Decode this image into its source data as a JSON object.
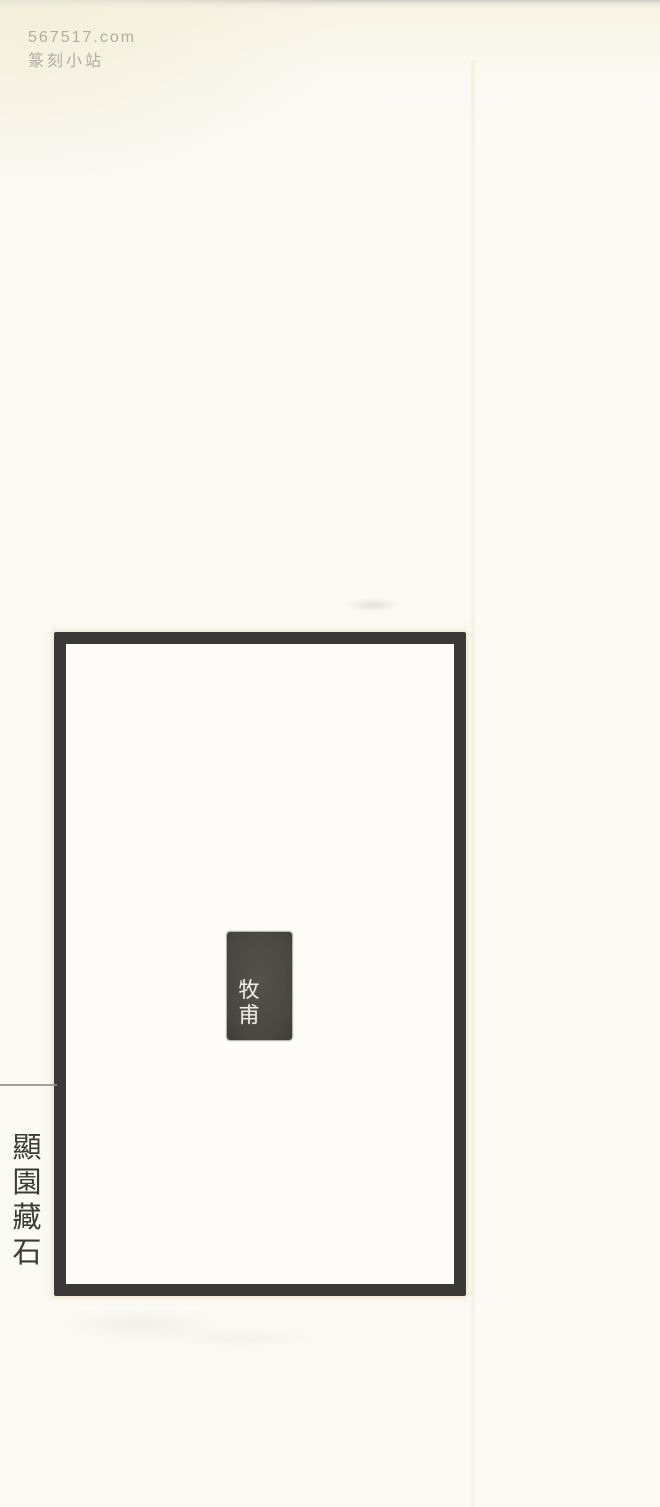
{
  "watermark": {
    "site": "567517.com",
    "name": "篆刻小站",
    "color": "#b0aca4"
  },
  "plate": {
    "border_color": "#3a3935",
    "paper_color": "#fdfcf8"
  },
  "seal": {
    "characters": [
      "牧",
      "甫"
    ],
    "ink_color": "#4c4a45",
    "glyph_color": "#efece3"
  },
  "side_caption": {
    "characters": [
      "顯",
      "園",
      "藏",
      "石"
    ],
    "ink_color": "#3d3b34"
  },
  "page_background": "#fbfaf5"
}
